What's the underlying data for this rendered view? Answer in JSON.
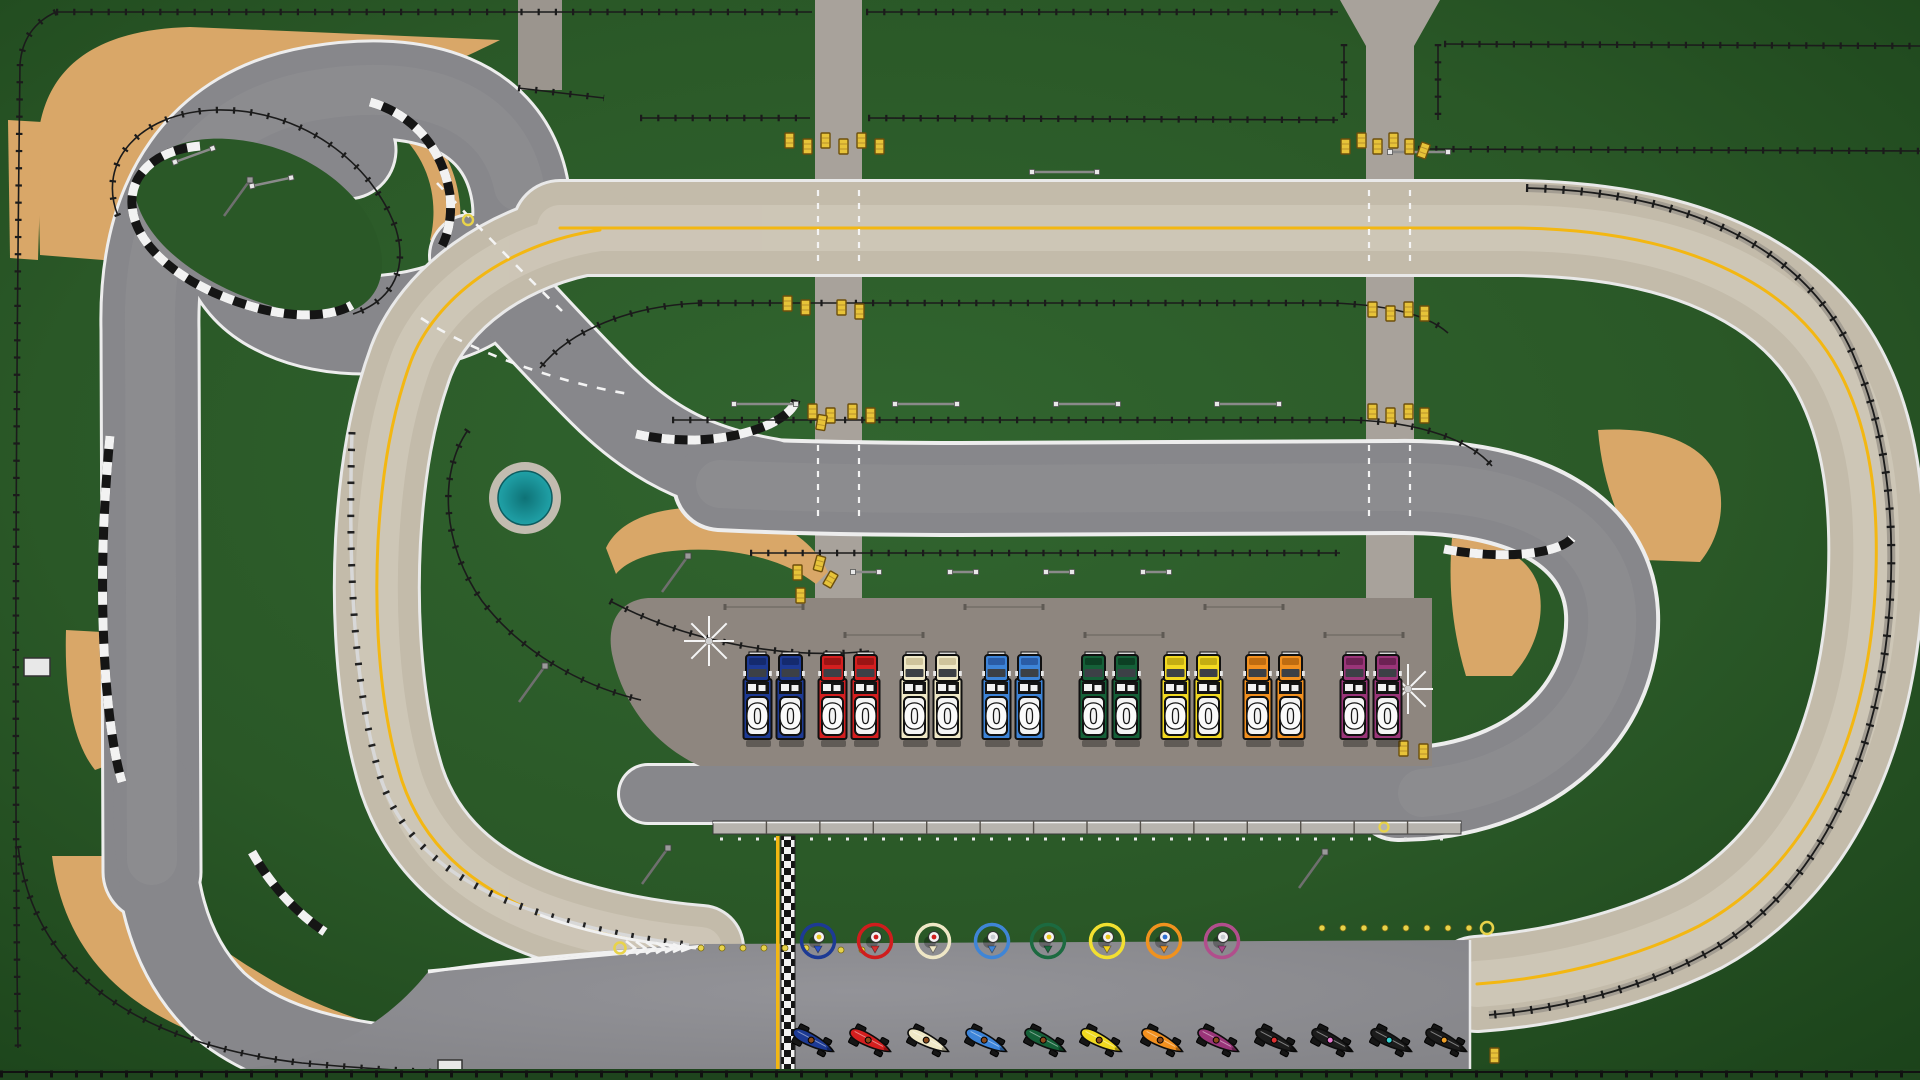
{
  "app": {
    "name": "Top-down racing game circuit overview",
    "view": "track-map"
  },
  "palette": {
    "grass_dark": "#1d461c",
    "grass": "#2b5a28",
    "track_gray": "#87878b",
    "track_worn": "#cdc5b4",
    "track_edge_white": "#efefef",
    "racing_line_yellow": "#f3b712",
    "sand": "#d9a768",
    "access_road": "#a8a29b",
    "paddock": "#8e867f",
    "apron": "#8b8b8f",
    "pit_wall": "#b7b4ae",
    "pond_water": "#1d9aa0",
    "pond_rim": "#c2bcb0",
    "kerb_black": "#151515",
    "kerb_white": "#f2f2f2",
    "fence": "#1b1b1b",
    "guardrail": "#d8d8d8",
    "hay_bale": "#e7c339",
    "dot_yellow": "#e8d34a"
  },
  "teams": [
    {
      "name": "navy",
      "truck_color": "#1d3a94",
      "truck_shade": "#142a6e",
      "ring_color": "#1d3a94",
      "marker_dot_color": "#e8c51d",
      "flag_color": "#2a52c8",
      "truck_digits": [
        "0",
        "0"
      ]
    },
    {
      "name": "red",
      "truck_color": "#d41f1f",
      "truck_shade": "#9c1414",
      "ring_color": "#cf1d1d",
      "marker_dot_color": "#cf1d1d",
      "flag_color": "#d43030",
      "truck_digits": [
        "0",
        "0"
      ]
    },
    {
      "name": "cream",
      "truck_color": "#efe8c6",
      "truck_shade": "#cfc49c",
      "ring_color": "#efe7c6",
      "marker_dot_color": "#cf1d1d",
      "flag_color": "#efe7c6",
      "truck_digits": [
        "0",
        "0"
      ]
    },
    {
      "name": "light-blue",
      "truck_color": "#3d84d8",
      "truck_shade": "#2a5ca6",
      "ring_color": "#3f85d6",
      "marker_dot_color": "#c9cdd2",
      "flag_color": "#3f85d6",
      "truck_digits": [
        "0",
        "0"
      ]
    },
    {
      "name": "green",
      "truck_color": "#156038",
      "truck_shade": "#0c4024",
      "ring_color": "#1c6a40",
      "marker_dot_color": "#e8c51d",
      "flag_color": "#1c6a40",
      "truck_digits": [
        "0",
        "0"
      ]
    },
    {
      "name": "yellow",
      "truck_color": "#f2d921",
      "truck_shade": "#c4ad12",
      "ring_color": "#f2e030",
      "marker_dot_color": "#e8c51d",
      "flag_color": "#f0d020",
      "truck_digits": [
        "0",
        "0"
      ]
    },
    {
      "name": "orange",
      "truck_color": "#f2901f",
      "truck_shade": "#bf6c10",
      "ring_color": "#f0921e",
      "marker_dot_color": "#2f6fd0",
      "flag_color": "#f0921e",
      "truck_digits": [
        "0",
        "0"
      ]
    },
    {
      "name": "purple",
      "truck_color": "#9a3579",
      "truck_shade": "#6d2254",
      "ring_color": "#b14e8c",
      "marker_dot_color": "#c9cdd2",
      "flag_color": "#a84587",
      "truck_digits": [
        "0",
        "0"
      ]
    }
  ],
  "pit": {
    "trucks_per_team": 2,
    "truck_total": 16,
    "wall_segments": 14
  },
  "grid_cars": [
    {
      "body_color": "#1d3a94",
      "cockpit_dot_color": "#8a4a1c"
    },
    {
      "body_color": "#d41f1f",
      "cockpit_dot_color": "#8a4a1c"
    },
    {
      "body_color": "#efe8c6",
      "cockpit_dot_color": "#8a4a1c"
    },
    {
      "body_color": "#3d84d8",
      "cockpit_dot_color": "#8a4a1c"
    },
    {
      "body_color": "#156038",
      "cockpit_dot_color": "#8a4a1c"
    },
    {
      "body_color": "#f2d921",
      "cockpit_dot_color": "#8a4a1c"
    },
    {
      "body_color": "#f2901f",
      "cockpit_dot_color": "#8a4a1c"
    },
    {
      "body_color": "#9a3579",
      "cockpit_dot_color": "#8a4a1c"
    },
    {
      "body_color": "#1c1c1c",
      "cockpit_dot_color": "#e03131"
    },
    {
      "body_color": "#1c1c1c",
      "cockpit_dot_color": "#e87bd0"
    },
    {
      "body_color": "#1c1c1c",
      "cockpit_dot_color": "#35d0d0"
    },
    {
      "body_color": "#1c1c1c",
      "cockpit_dot_color": "#f0a028"
    }
  ],
  "start_finish": {
    "line_style": "checkered",
    "columns": 2
  }
}
